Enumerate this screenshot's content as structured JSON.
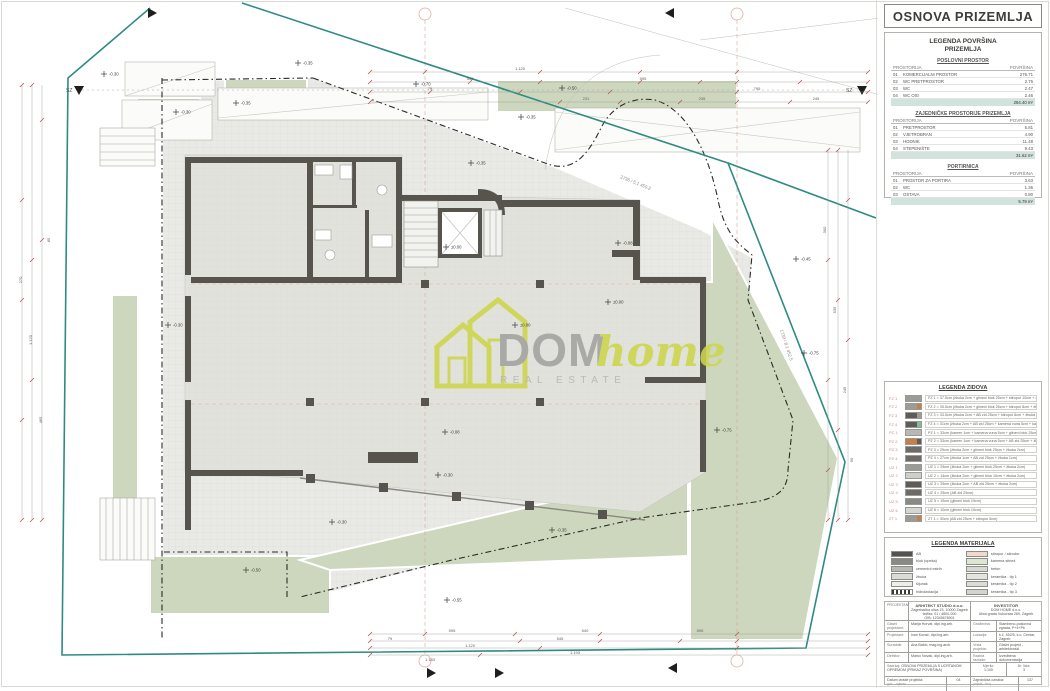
{
  "sheet": {
    "title": "OSNOVA PRIZEMLJA"
  },
  "colors": {
    "site_boundary_teal": "#2e8b82",
    "wall_dark": "#57534d",
    "green_area": "#ccd7bd",
    "dimension_red": "#b0564c",
    "grid_bubble": "#dcae9f",
    "total_row_bg": "#d2e2dc",
    "logo_green": "#ccd64b",
    "logo_gray": "#a2a29e"
  },
  "area_legend": {
    "heading_line1": "LEGENDA POVRŠINA",
    "heading_line2": "PRIZEMLJA",
    "col_room": "PROSTORIJA",
    "col_area": "POVRŠINA",
    "sections": [
      {
        "title": "POSLOVNI PROSTOR",
        "rows": [
          [
            "01",
            "KOMERCIJALNI PROSTOR",
            "276.71"
          ],
          [
            "02",
            "WC PRETPROSTOR",
            "2.76"
          ],
          [
            "03",
            "WC",
            "2.47"
          ],
          [
            "04",
            "WC OSI",
            "2.46"
          ]
        ],
        "total": "284.40 m²"
      },
      {
        "title": "ZAJEDNIČKE PROSTORIJE PRIZEMLJA",
        "rows": [
          [
            "01",
            "PRETPROSTOR",
            "5.81"
          ],
          [
            "02",
            "VJETROBRAN",
            "4.90"
          ],
          [
            "03",
            "HODNIK",
            "11.48"
          ],
          [
            "04",
            "STEPENIŠTE",
            "9.43"
          ]
        ],
        "total": "31.62 m²"
      },
      {
        "title": "PORTIRNICA",
        "rows": [
          [
            "01",
            "PROSTOR ZA PORTIRA",
            "3.63"
          ],
          [
            "02",
            "WC",
            "1.36"
          ],
          [
            "03",
            "OSTAVA",
            "0.80"
          ]
        ],
        "total": "5.79 m²"
      }
    ]
  },
  "wall_legend": {
    "title": "LEGENDA ZIDOVA",
    "rows": [
      {
        "code": "FZ 1",
        "c1": "#9c9c96",
        "c2": "#9c9c96",
        "desc": "FZ 1 = 37.5cm (žbuka 2cm + glineni blok 25cm + stiropor 10cm + žbuka 0.5cm)"
      },
      {
        "code": "FZ 2",
        "c1": "#9c9c96",
        "c2": "#c97f43",
        "desc": "FZ 2 = 35.5cm (žbuka 2cm + glineni blok 25cm + stiropor 8cm + žbuka 0.5cm)"
      },
      {
        "code": "FZ 3",
        "c1": "#5f5c57",
        "c2": "#9c9c96",
        "desc": "FZ 3 = 33.5cm (žbuka 2cm + AB zid 25cm + stiropor 6cm + žbuka 0.5cm)"
      },
      {
        "code": "FZ 4",
        "c1": "#5f5c57",
        "c2": "#7fbf8f",
        "desc": "FZ 4 = 31cm (žbuka 2cm + AB zid 25cm + kamena vuna 5cm + kamen 1cm)"
      },
      {
        "code": "PZ 1",
        "c1": "#b9b9b3",
        "c2": "#b9b9b3",
        "desc": "PZ 1 = 33cm (kamen 1cm + kamena vuna 5cm + glineni blok 25cm + žbuka 2cm)"
      },
      {
        "code": "PZ 2",
        "c1": "#c97f43",
        "c2": "#5f5c57",
        "desc": "PZ 2 = 33cm (kamen 1cm + kamena vuna 5cm + AB zid 25cm + žbuka 2cm)"
      },
      {
        "code": "PZ 3",
        "c1": "#6e6b66",
        "c2": "#6e6b66",
        "desc": "PZ 3 = 29cm (žbuka 2cm + glineni blok 25cm + žbuka 2cm)"
      },
      {
        "code": "PZ 4",
        "c1": "#6e6b66",
        "c2": "#6e6b66",
        "desc": "PZ 4 = 27cm (žbuka 1cm + AB zid 25cm + žbuka 1cm)"
      },
      {
        "code": "UZ 1",
        "c1": "#9c9c96",
        "c2": "#9c9c96",
        "desc": "UZ 1 = 29cm (žbuka 2cm + glineni blok 25cm + žbuka 2cm)"
      },
      {
        "code": "UZ 2",
        "c1": "#cfcfc9",
        "c2": "#cfcfc9",
        "desc": "UZ 2 = 14cm (žbuka 2cm + glineni blok 10cm + žbuka 2cm)"
      },
      {
        "code": "UZ 3",
        "c1": "#5f5c57",
        "c2": "#5f5c57",
        "desc": "UZ 3 = 29cm (žbuka 2cm + AB zid 25cm + žbuka 2cm)"
      },
      {
        "code": "UZ 4",
        "c1": "#6e6b66",
        "c2": "#6e6b66",
        "desc": "UZ 4 = 25cm (AB zid 25cm)"
      },
      {
        "code": "UZ 5",
        "c1": "#8a8a84",
        "c2": "#8a8a84",
        "desc": "UZ 5 = 19cm (glineni blok 19cm)"
      },
      {
        "code": "UZ 6",
        "c1": "#d6d6d0",
        "c2": "#d6d6d0",
        "desc": "UZ 6 = 10cm (glineni blok 10cm)"
      },
      {
        "code": "ZT 1",
        "c1": "#9c9c96",
        "c2": "#c97f43",
        "desc": "ZT 1 = 30cm (AB zid 25cm + stiropor 5cm)"
      }
    ]
  },
  "material_legend": {
    "title": "LEGENDA MATERIJALA",
    "left": [
      {
        "label": "AB",
        "sw": "#55524e"
      },
      {
        "label": "blok (opeka)",
        "sw": "#8a8a84"
      },
      {
        "label": "cementni estrih",
        "sw": "#b8b8b2"
      },
      {
        "label": "žbuka",
        "sw": "#dcdcd6"
      },
      {
        "label": "šljunak",
        "sw": "#eeeee8"
      },
      {
        "label": "hidroizolacija",
        "sw": "stripes"
      }
    ],
    "right": [
      {
        "label": "stiropor / stirodur",
        "sw": "#f2d8cf"
      },
      {
        "label": "kamena sitnež",
        "sw": "#dde5d3"
      },
      {
        "label": "beton",
        "sw": "#d8d8d2"
      },
      {
        "label": "keramika - tip 1",
        "sw": "#e4e4de"
      },
      {
        "label": "keramika - tip 2",
        "sw": "#dcdcd6"
      },
      {
        "label": "keramika - tip 3",
        "sw": "#d4d4ce"
      }
    ]
  },
  "title_block": {
    "projektant_label": "PROJEKTANT:",
    "projektant_firm": "ARHITEKT STUDIO d.o.o.",
    "projektant_addr1": "Zagrebačka ulica 15, 10000 Zagreb",
    "projektant_addr2": "tel/fax: 01 / 4800-000",
    "projektant_addr3": "OIB: 12345678901",
    "investitor_label": "INVESTITOR",
    "investitor_name": "DOM HOME d.o.o.",
    "investitor_addr": "Ulica grada Vukovara 269, Zagreb",
    "rows": [
      {
        "l": "Glavni projektant:",
        "v": "Marija Horvat, dipl.ing.arh.",
        "rl": "Građevina:",
        "rv": "Stambeno-poslovna zgrada, P+4+Pk"
      },
      {
        "l": "Projektant:",
        "v": "Ivan Kovač, dipl.ing.arh.",
        "rl": "Lokacija:",
        "rv": "k.č. 452/5, k.o. Centar, Zagreb"
      },
      {
        "l": "Suradnik:",
        "v": "Ana Babić, mag.ing.arch.",
        "rl": "Vrsta projekta:",
        "rv": "Glavni projekt - arhitektonski"
      },
      {
        "l": "Direktor:",
        "v": "Marko Novak, dipl.ing.arh.",
        "rl": "Razina razrade:",
        "rv": "Izvedbena dokumentacija"
      }
    ],
    "sadrzaj_label": "Sadržaj:",
    "sadrzaj": "OSNOVA PRIZEMLJA S UCRTANOM OPREMOM (PRIKAZ POVRŠINA)",
    "mjerilo_label": "Mjerilo:",
    "mjerilo": "1:100",
    "list_label": "Br. lista:",
    "list": "3",
    "datum_label": "Datum izrade projekta:",
    "datum_sub": "god. - mjesec",
    "datum": "04",
    "oznaka_label": "Zajednička oznaka:",
    "oznaka_sub": "projekt - broj",
    "oznaka": "137"
  },
  "logo": {
    "dom": "DOM",
    "home": "home",
    "tagline": "REAL ESTATE"
  },
  "plan": {
    "section_label": "SZ",
    "level_markers": [
      {
        "x": 104,
        "y": 74,
        "v": "-0.30"
      },
      {
        "x": 176,
        "y": 112,
        "v": "-0.30"
      },
      {
        "x": 236,
        "y": 103,
        "v": "-0.35"
      },
      {
        "x": 298,
        "y": 63,
        "v": "-0.35"
      },
      {
        "x": 416,
        "y": 84,
        "v": "-0.70"
      },
      {
        "x": 521,
        "y": 117,
        "v": "-0.35"
      },
      {
        "x": 562,
        "y": 88,
        "v": "-0.50"
      },
      {
        "x": 471,
        "y": 163,
        "v": "-0.35"
      },
      {
        "x": 618,
        "y": 243,
        "v": "-0.08"
      },
      {
        "x": 446,
        "y": 247,
        "v": "±0.00"
      },
      {
        "x": 515,
        "y": 325,
        "v": "±0.00"
      },
      {
        "x": 608,
        "y": 302,
        "v": "±0.00"
      },
      {
        "x": 445,
        "y": 432,
        "v": "-0.08"
      },
      {
        "x": 168,
        "y": 325,
        "v": "-0.30"
      },
      {
        "x": 804,
        "y": 353,
        "v": "-0.75"
      },
      {
        "x": 717,
        "y": 430,
        "v": "-0.75"
      },
      {
        "x": 438,
        "y": 475,
        "v": "-0.30"
      },
      {
        "x": 332,
        "y": 522,
        "v": "-0.30"
      },
      {
        "x": 552,
        "y": 530,
        "v": "-0.35"
      },
      {
        "x": 246,
        "y": 570,
        "v": "-0.50"
      },
      {
        "x": 447,
        "y": 600,
        "v": "-0.55"
      },
      {
        "x": 796,
        "y": 259,
        "v": "-0.45"
      }
    ],
    "dim_labels": [
      {
        "x": 520,
        "y": 70,
        "t": "1.120"
      },
      {
        "x": 643,
        "y": 80,
        "t": "595"
      },
      {
        "x": 757,
        "y": 90,
        "t": "795"
      },
      {
        "x": 586,
        "y": 100,
        "t": "231"
      },
      {
        "x": 702,
        "y": 100,
        "t": "235"
      },
      {
        "x": 816,
        "y": 100,
        "t": "245"
      },
      {
        "x": 430,
        "y": 90,
        "t": "79"
      },
      {
        "x": 470,
        "y": 80,
        "t": "535"
      },
      {
        "x": 452,
        "y": 632,
        "t": "595"
      },
      {
        "x": 585,
        "y": 632,
        "t": "540"
      },
      {
        "x": 700,
        "y": 632,
        "t": "595"
      },
      {
        "x": 560,
        "y": 640,
        "t": "545"
      },
      {
        "x": 470,
        "y": 647,
        "t": "1.120"
      },
      {
        "x": 575,
        "y": 654,
        "t": "1.193"
      },
      {
        "x": 430,
        "y": 661,
        "t": "1.183"
      },
      {
        "x": 390,
        "y": 640,
        "t": "79"
      },
      {
        "x": 22,
        "y": 280,
        "t": "270",
        "r": -90
      },
      {
        "x": 32,
        "y": 340,
        "t": "1.120",
        "r": -90
      },
      {
        "x": 42,
        "y": 420,
        "t": "465",
        "r": -90
      },
      {
        "x": 50,
        "y": 240,
        "t": "85",
        "r": -90
      },
      {
        "x": 826,
        "y": 230,
        "t": "300",
        "r": -90
      },
      {
        "x": 836,
        "y": 310,
        "t": "535",
        "r": -90
      },
      {
        "x": 846,
        "y": 390,
        "t": "245",
        "r": -90
      },
      {
        "x": 853,
        "y": 460,
        "t": "90",
        "r": -90
      }
    ],
    "parcel_labels": [
      {
        "x": 620,
        "y": 178,
        "r": 22,
        "t": "2736 / 5.1  450.2"
      },
      {
        "x": 780,
        "y": 330,
        "r": 72,
        "t": "1739 / 8.1  452.5"
      }
    ],
    "chains": [
      {
        "x1": 370,
        "x2": 868,
        "y": 72,
        "ticks": [
          370,
          425,
          540,
          640,
          737,
          868
        ]
      },
      {
        "x1": 370,
        "x2": 868,
        "y": 82,
        "ticks": [
          370,
          470,
          540,
          640,
          700,
          737,
          800,
          868
        ]
      },
      {
        "x1": 370,
        "x2": 868,
        "y": 92,
        "ticks": [
          370,
          430,
          520,
          610,
          737,
          868
        ]
      },
      {
        "x1": 370,
        "x2": 868,
        "y": 102,
        "ticks": [
          370,
          560,
          620,
          680,
          737,
          790,
          868
        ]
      },
      {
        "x1": 370,
        "x2": 868,
        "y": 634,
        "ticks": [
          370,
          425,
          515,
          600,
          737,
          868
        ]
      },
      {
        "x1": 370,
        "x2": 868,
        "y": 641,
        "ticks": [
          370,
          520,
          600,
          680,
          737,
          868
        ]
      },
      {
        "x1": 370,
        "x2": 868,
        "y": 648,
        "ticks": [
          370,
          540,
          737,
          868
        ]
      },
      {
        "x1": 370,
        "x2": 868,
        "y": 655,
        "ticks": [
          370,
          480,
          868
        ]
      }
    ],
    "vchains": [
      {
        "y1": 85,
        "y2": 520,
        "x": 22,
        "ticks": [
          85,
          200,
          300,
          420,
          520
        ]
      },
      {
        "y1": 85,
        "y2": 520,
        "x": 32,
        "ticks": [
          85,
          260,
          380,
          520
        ]
      },
      {
        "y1": 85,
        "y2": 520,
        "x": 42,
        "ticks": [
          120,
          240,
          520
        ]
      },
      {
        "y1": 150,
        "y2": 520,
        "x": 828,
        "ticks": [
          150,
          260,
          380,
          470,
          520
        ]
      },
      {
        "y1": 150,
        "y2": 520,
        "x": 838,
        "ticks": [
          150,
          300,
          430,
          520
        ]
      },
      {
        "y1": 150,
        "y2": 520,
        "x": 848,
        "ticks": [
          200,
          340,
          520
        ]
      }
    ]
  }
}
